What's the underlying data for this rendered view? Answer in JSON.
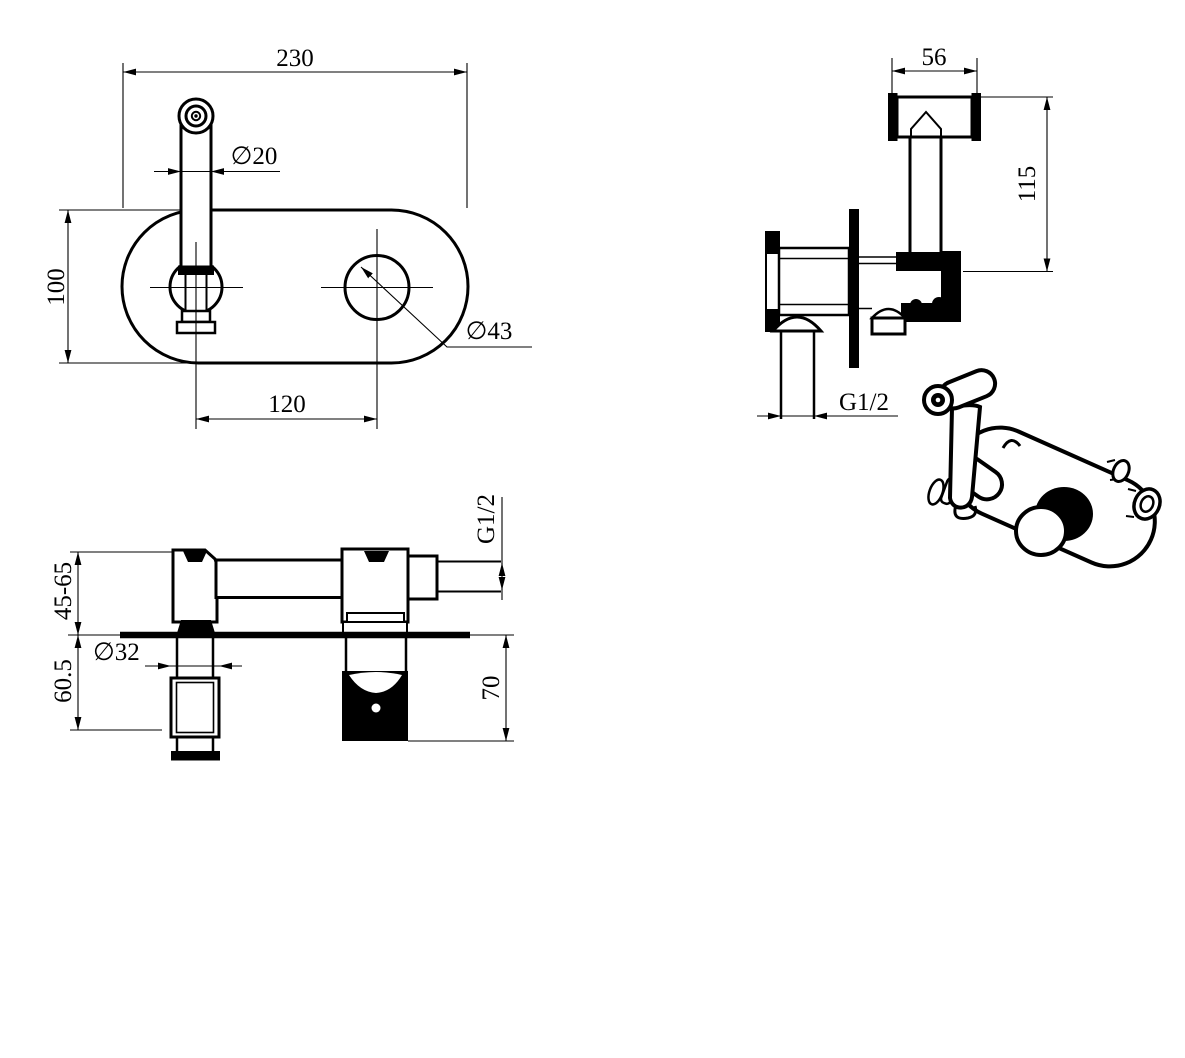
{
  "views": {
    "front": {
      "dims": {
        "plate_width": "230",
        "spout_diameter": "∅20",
        "plate_height": "100",
        "handle_hole_diameter": "∅43",
        "hole_spacing": "120"
      }
    },
    "sprayer": {
      "dims": {
        "head_width": "56",
        "height": "115",
        "inlet_thread": "G1/2"
      }
    },
    "mixer": {
      "dims": {
        "mount_depth_range": "45-65",
        "lower_depth": "60.5",
        "valve_diameter": "∅32",
        "embed_depth": "70",
        "outlet_thread": "G1/2"
      }
    }
  },
  "colors": {
    "line": "#000000",
    "background": "#ffffff"
  }
}
